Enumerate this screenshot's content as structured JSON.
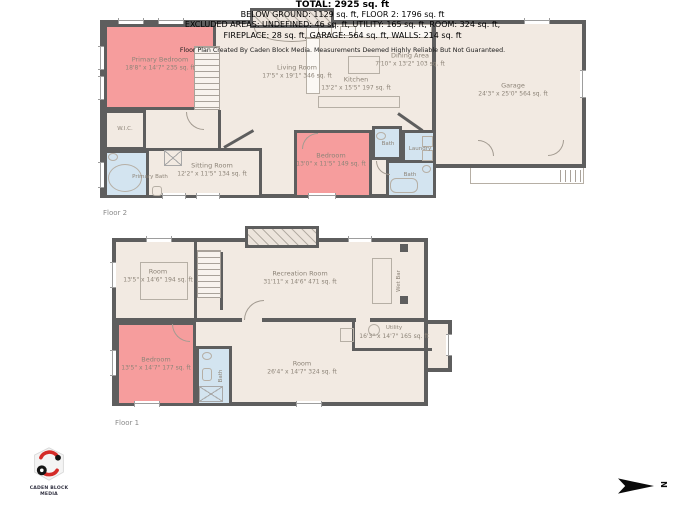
{
  "palette": {
    "wall": "#5e5e5e",
    "floor_fill": "#f2eae2",
    "bedroom_fill": "#f69d9d",
    "bath_fill": "#d3e4f0",
    "label_text": "#8d8478",
    "logo_red": "#d42b28",
    "arrow_black": "#0b0b0b"
  },
  "floor2": {
    "label": "Floor 2",
    "rooms": {
      "primary_bedroom": {
        "name": "Primary Bedroom",
        "dims": "18'8\" x 14'7\" 235 sq. ft"
      },
      "living_room": {
        "name": "Living Room",
        "dims": "17'5\" x 19'1\" 346 sq. ft"
      },
      "kitchen": {
        "name": "Kitchen",
        "dims": "13'2\" x 15'5\" 197 sq. ft"
      },
      "dining_area": {
        "name": "Dining Area",
        "dims": "7'10\" x 13'2\" 103 sq. ft"
      },
      "garage": {
        "name": "Garage",
        "dims": "24'3\" x 25'0\" 564 sq. ft"
      },
      "wic": {
        "name": "W.I.C."
      },
      "primary_bath": {
        "name": "Primary Bath"
      },
      "sitting_room": {
        "name": "Sitting Room",
        "dims": "12'2\" x 11'5\" 134 sq. ft"
      },
      "bedroom": {
        "name": "Bedroom",
        "dims": "13'0\" x 11'5\" 149 sq. ft"
      },
      "bath_upper": {
        "name": "Bath"
      },
      "laundry": {
        "name": "Laundry"
      },
      "bath_lower": {
        "name": "Bath"
      }
    }
  },
  "floor1": {
    "label": "Floor 1",
    "rooms": {
      "room_upper": {
        "name": "Room",
        "dims": "13'5\" x 14'6\" 194 sq. ft"
      },
      "recreation_room": {
        "name": "Recreation Room",
        "dims": "31'11\" x 14'6\" 471 sq. ft"
      },
      "wet_bar": {
        "name": "Wet Bar"
      },
      "bedroom": {
        "name": "Bedroom",
        "dims": "13'5\" x 14'7\" 177 sq. ft"
      },
      "bath": {
        "name": "Bath"
      },
      "room_lower": {
        "name": "Room",
        "dims": "26'4\" x 14'7\" 324 sq. ft"
      },
      "utility": {
        "name": "Utility",
        "dims": "16'3\" x 14'7\" 165 sq. ft"
      }
    }
  },
  "summary": {
    "total": "TOTAL: 2925 sq. ft",
    "line1": "BELOW GROUND: 1129 sq. ft, FLOOR 2: 1796 sq. ft",
    "line2": "EXCLUDED AREAS: UNDEFINED: 46 sq. ft, UTILITY: 165 sq. ft, ROOM: 324 sq. ft,",
    "line3": "FIREPLACE: 28 sq. ft, GARAGE: 564 sq. ft, WALLS: 214 sq. ft",
    "disclaimer": "Floor Plan Created By Caden Block Media. Measurements Deemed Highly Reliable But Not Guaranteed."
  },
  "branding": {
    "company_line1": "CADEN BLOCK",
    "company_line2": "MEDIA"
  },
  "compass": {
    "north": "N"
  }
}
